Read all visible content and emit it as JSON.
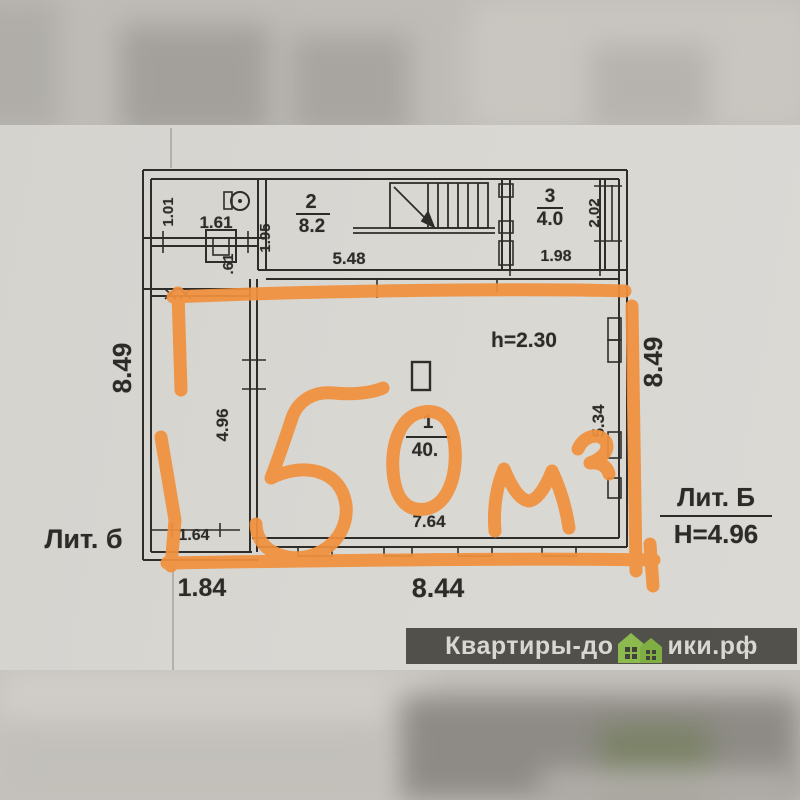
{
  "plan": {
    "litera_left": "Лит. б",
    "litera_right": "Лит. Б",
    "building_height": "Н=4.96",
    "ceiling_height": "h=2.30",
    "rooms": [
      {
        "number": "2",
        "area": "8.2"
      },
      {
        "number": "3",
        "area": "4.0"
      },
      {
        "number": "1",
        "area": "40."
      }
    ],
    "dimensions": {
      "annex_width": "1.01",
      "annex_inner": "1.61",
      "annex_door": ".61",
      "room2_left": "1.95",
      "room2_width": "5.48",
      "room3_width": "1.98",
      "room3_depth": "2.02",
      "left_outer": "8.49",
      "strip_inner": "4.96",
      "strip_bottom": "1.64",
      "bottom_annex": "1.84",
      "bottom_main": "8.44",
      "room1_width": "7.64",
      "room1_right": "5.34",
      "right_outer": "8.49"
    }
  },
  "annotation": {
    "text": "50 м²",
    "color": "#f0913d"
  },
  "watermark": {
    "left": "Квартиры-до",
    "right": "ики.рф",
    "icon": "houses-icon",
    "bg": "#42413c",
    "fg": "#d8d7d2",
    "green": "#8cba4e"
  },
  "palette": {
    "paper": "#d8d6d1",
    "ink": "#2d2b28",
    "highlight_orange": "#f0913d"
  }
}
